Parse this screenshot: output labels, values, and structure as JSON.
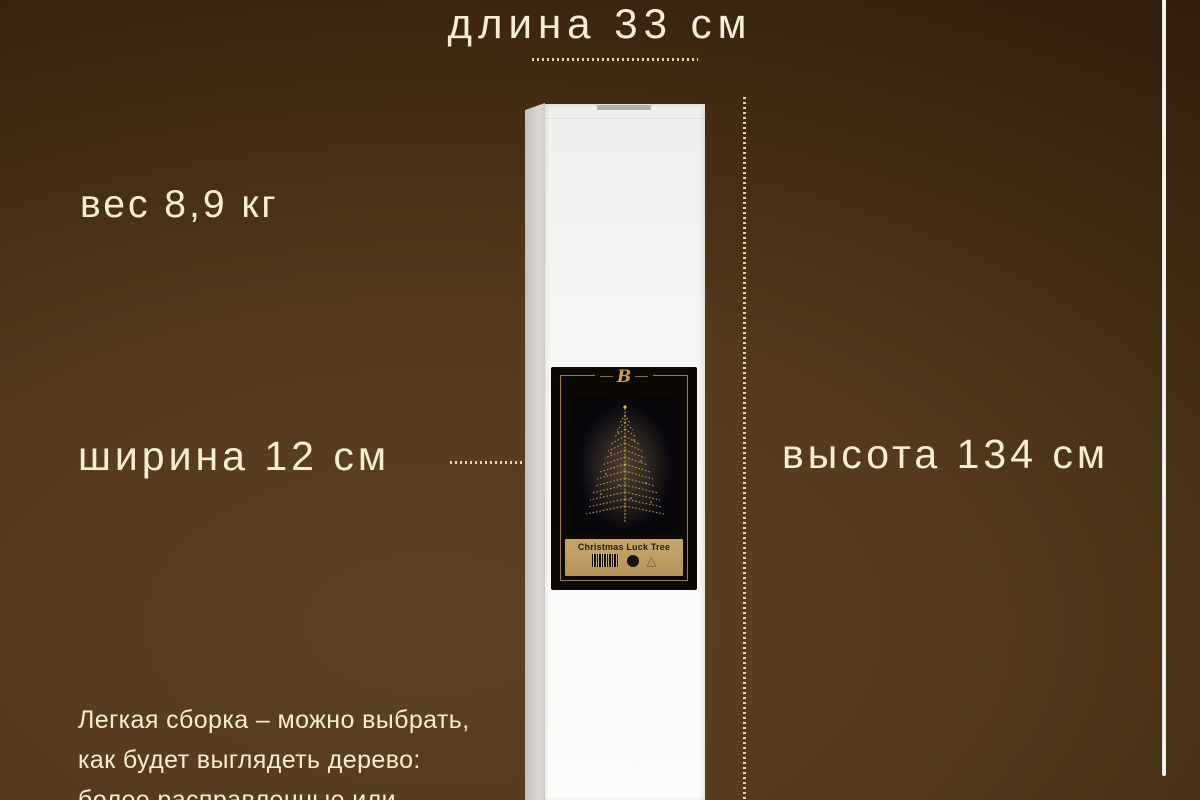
{
  "page": {
    "type": "product-dimensions-infographic",
    "language": "ru",
    "colors": {
      "background_center": "#5d4124",
      "background_edge": "#281806",
      "text_cream": "#f7eed3",
      "gold_accent": "#c8a050",
      "banner_tan": "#bd9d64",
      "box_white": "#f5f4f2",
      "label_black": "#0c0906"
    }
  },
  "annotations": {
    "length_label": "длина 33 см",
    "weight_label": "вес 8,9 кг",
    "width_label": "ширина 12 см",
    "height_label": "высота 134 см"
  },
  "description_lines": [
    "Легкая сборка – можно выбрать,",
    "как будет выглядеть дерево:",
    "более расправленные или"
  ],
  "box_label": {
    "brand_initial": "B",
    "product_name": "Christmas Luck Tree",
    "icons": [
      "barcode-icon",
      "circle-icon",
      "triangle-icon"
    ],
    "triangle_glyph": "△"
  }
}
